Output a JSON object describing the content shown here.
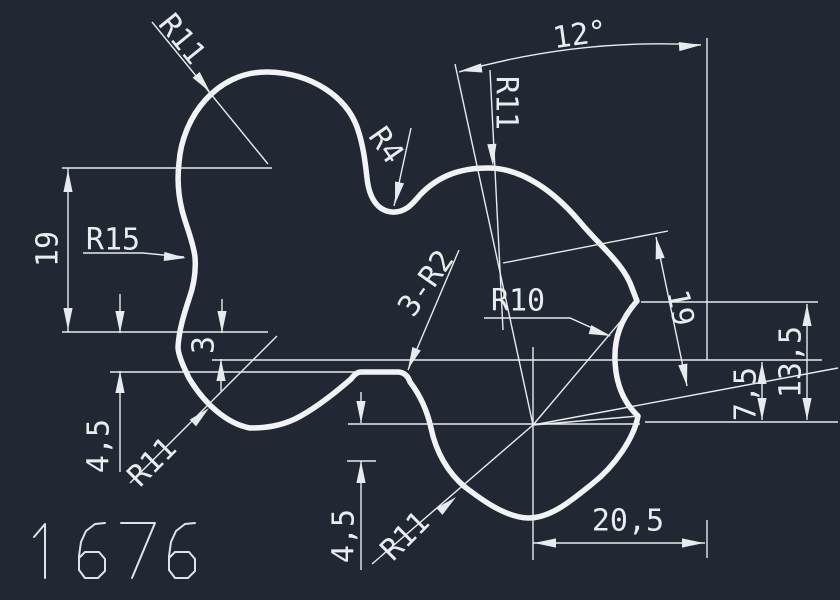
{
  "canvas": {
    "background_color": "#212833",
    "line_color": "#e8ebee",
    "outline_color": "#f1f3f5"
  },
  "drawing_number": "1676",
  "annotations": [
    {
      "id": "r11-top-left",
      "text": "R11",
      "x": 181,
      "y": 40,
      "rot": 51,
      "size": 30
    },
    {
      "id": "r4",
      "text": "R4",
      "x": 385,
      "y": 146,
      "rot": 55,
      "size": 30
    },
    {
      "id": "angle-12",
      "text": "12°",
      "x": 580,
      "y": 36,
      "rot": -8,
      "size": 31
    },
    {
      "id": "r11-upper-mid",
      "text": "R11",
      "x": 505,
      "y": 103,
      "rot": 90,
      "size": 30
    },
    {
      "id": "r15",
      "text": "R15",
      "x": 113,
      "y": 241,
      "rot": 0,
      "size": 30
    },
    {
      "id": "dim-19-left",
      "text": "19",
      "x": 49,
      "y": 249,
      "rot": -90,
      "size": 30
    },
    {
      "id": "dim-3",
      "text": "3",
      "x": 205,
      "y": 345,
      "rot": -90,
      "size": 30
    },
    {
      "id": "dim-4-5-left",
      "text": "4,5",
      "x": 100,
      "y": 446,
      "rot": -90,
      "size": 30
    },
    {
      "id": "r11-bottom-left",
      "text": "R11",
      "x": 153,
      "y": 463,
      "rot": -45,
      "size": 30
    },
    {
      "id": "three-r2",
      "text": "3-R2",
      "x": 427,
      "y": 284,
      "rot": -55,
      "size": 30
    },
    {
      "id": "r10",
      "text": "R10",
      "x": 518,
      "y": 302,
      "rot": 0,
      "size": 32
    },
    {
      "id": "dim-19-right",
      "text": "19",
      "x": 679,
      "y": 308,
      "rot": 79,
      "size": 30
    },
    {
      "id": "dim-7-5",
      "text": "7,5",
      "x": 747,
      "y": 394,
      "rot": -90,
      "size": 30
    },
    {
      "id": "dim-13-5",
      "text": "13,5",
      "x": 792,
      "y": 362,
      "rot": -90,
      "size": 30
    },
    {
      "id": "dim-4-5-mid",
      "text": "4,5",
      "x": 345,
      "y": 536,
      "rot": -90,
      "size": 30
    },
    {
      "id": "r11-bottom-mid",
      "text": "R11",
      "x": 406,
      "y": 537,
      "rot": -45,
      "size": 30
    },
    {
      "id": "dim-20-5",
      "text": "20,5",
      "x": 628,
      "y": 522,
      "rot": 0,
      "size": 30
    }
  ]
}
